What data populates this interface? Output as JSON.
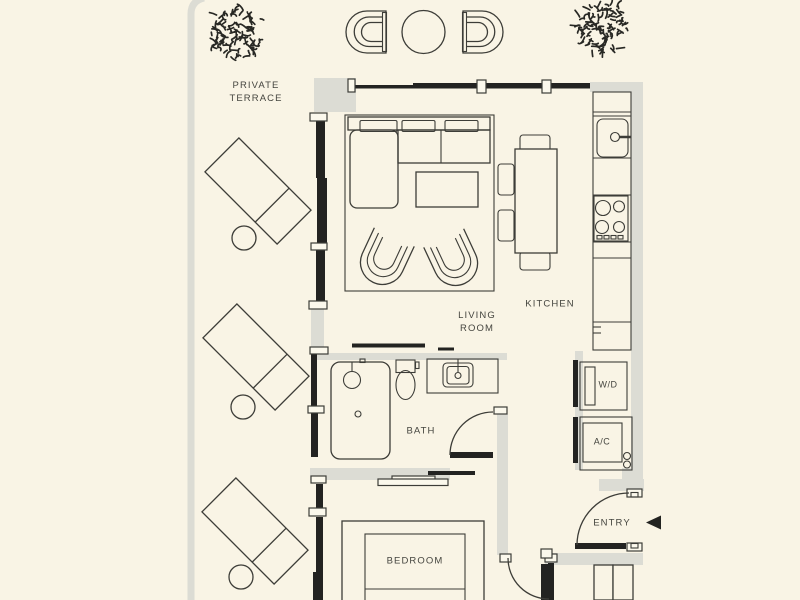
{
  "title": "Apartment floor plan",
  "colors": {
    "background": "#f9f4e5",
    "wall_dark": "#232321",
    "wall_light": "#dcdcd4",
    "linework": "#3d3d38",
    "text": "#45453f"
  },
  "rooms": {
    "terrace": {
      "line1": "PRIVATE",
      "line2": "TERRACE"
    },
    "living": {
      "line1": "LIVING",
      "line2": "ROOM"
    },
    "kitchen": {
      "label": "KITCHEN"
    },
    "bath": {
      "label": "BATH"
    },
    "bedroom": {
      "label": "BEDROOM"
    },
    "laundry": {
      "label": "W/D"
    },
    "hvac": {
      "label": "A/C"
    },
    "entry": {
      "label": "ENTRY"
    }
  },
  "icons": {
    "tree": "tree-icon",
    "entry_arrow": "entry-direction-arrow"
  }
}
